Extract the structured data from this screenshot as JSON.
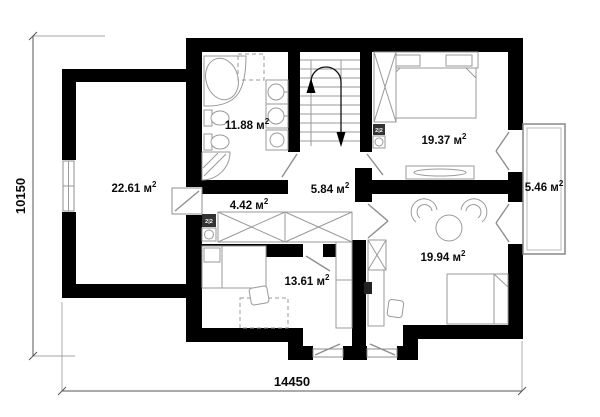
{
  "plan": {
    "type": "floor-plan",
    "rooms": [
      {
        "id": "room-left",
        "label": "22.61 м",
        "sup": "2"
      },
      {
        "id": "bathroom",
        "label": "11.88 м",
        "sup": "2"
      },
      {
        "id": "bedroom-top-right",
        "label": "19.37 м",
        "sup": "2"
      },
      {
        "id": "corridor",
        "label": "4.42 м",
        "sup": "2"
      },
      {
        "id": "hall",
        "label": "5.84 м",
        "sup": "2"
      },
      {
        "id": "balcony",
        "label": "5.46 м",
        "sup": "2"
      },
      {
        "id": "bedroom-bottom",
        "label": "13.61 м",
        "sup": "2"
      },
      {
        "id": "bedroom-right",
        "label": "19.94 м",
        "sup": "2"
      }
    ],
    "dimensions": {
      "height_mm": "10150",
      "width_mm": "14450"
    },
    "badges": {
      "panel_label": "2|2"
    },
    "colors": {
      "wall": "#000000",
      "furniture_stroke": "#9a9a9a",
      "dimension": "#555555",
      "background": "#ffffff"
    }
  }
}
